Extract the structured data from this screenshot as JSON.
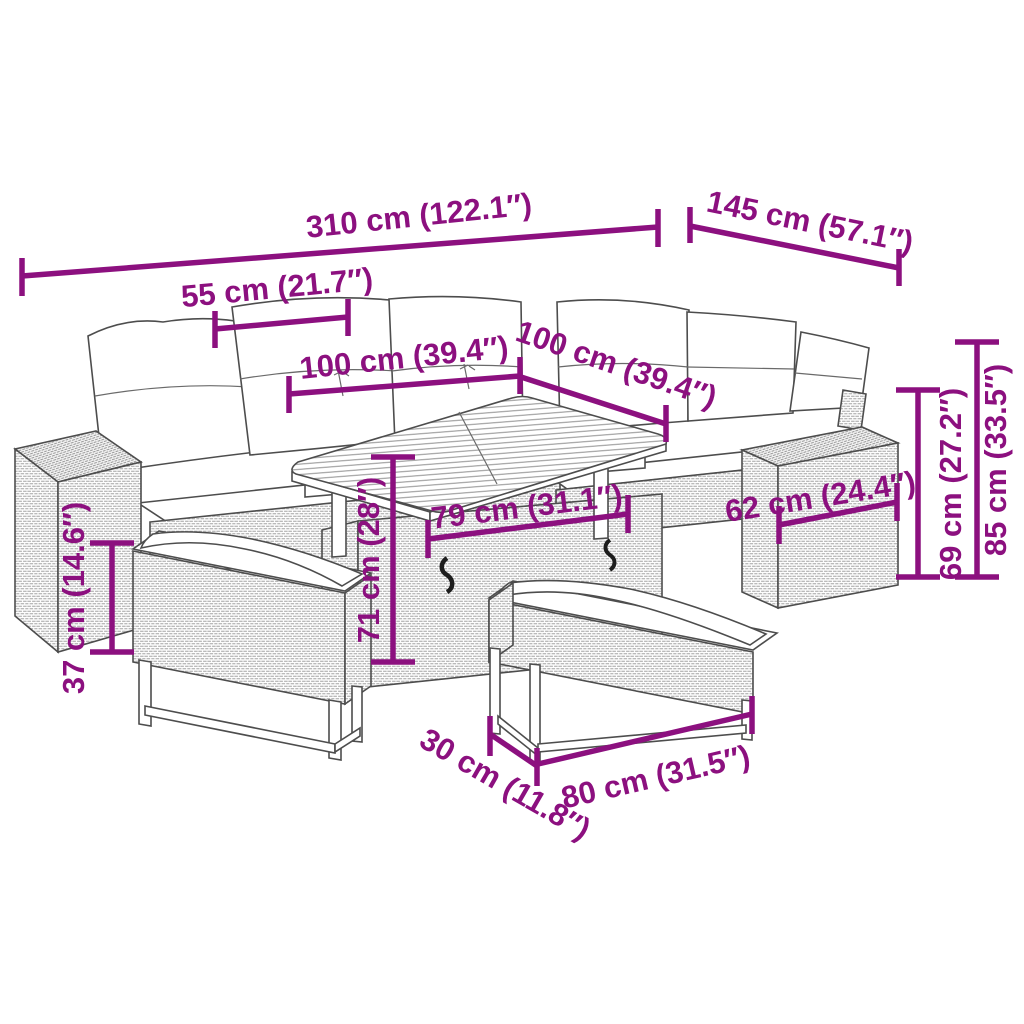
{
  "colors": {
    "dimension": "#8C107F",
    "outline": "#4d4d4d",
    "background": "#ffffff"
  },
  "dimensions": {
    "total_length": {
      "label": "310 cm (122.1″)"
    },
    "total_depth": {
      "label": "145 cm (57.1″)"
    },
    "armrest_module": {
      "label": "55 cm (21.7″)"
    },
    "seat_length_left": {
      "label": "100 cm (39.4″)"
    },
    "seat_length_right": {
      "label": "100 cm (39.4″)"
    },
    "table_length": {
      "label": "79 cm (31.1″)"
    },
    "side_box_depth": {
      "label": "62 cm (24.4″)"
    },
    "table_height": {
      "label": "71 cm (28″)"
    },
    "bench_height": {
      "label": "37 cm (14.6″)"
    },
    "seat_unit_height": {
      "label": "69 cm (27.2″)"
    },
    "total_height": {
      "label": "85 cm (33.5″)"
    },
    "bench_depth": {
      "label": "30 cm (11.8″)"
    },
    "bench_length": {
      "label": "80 cm (31.5″)"
    }
  }
}
